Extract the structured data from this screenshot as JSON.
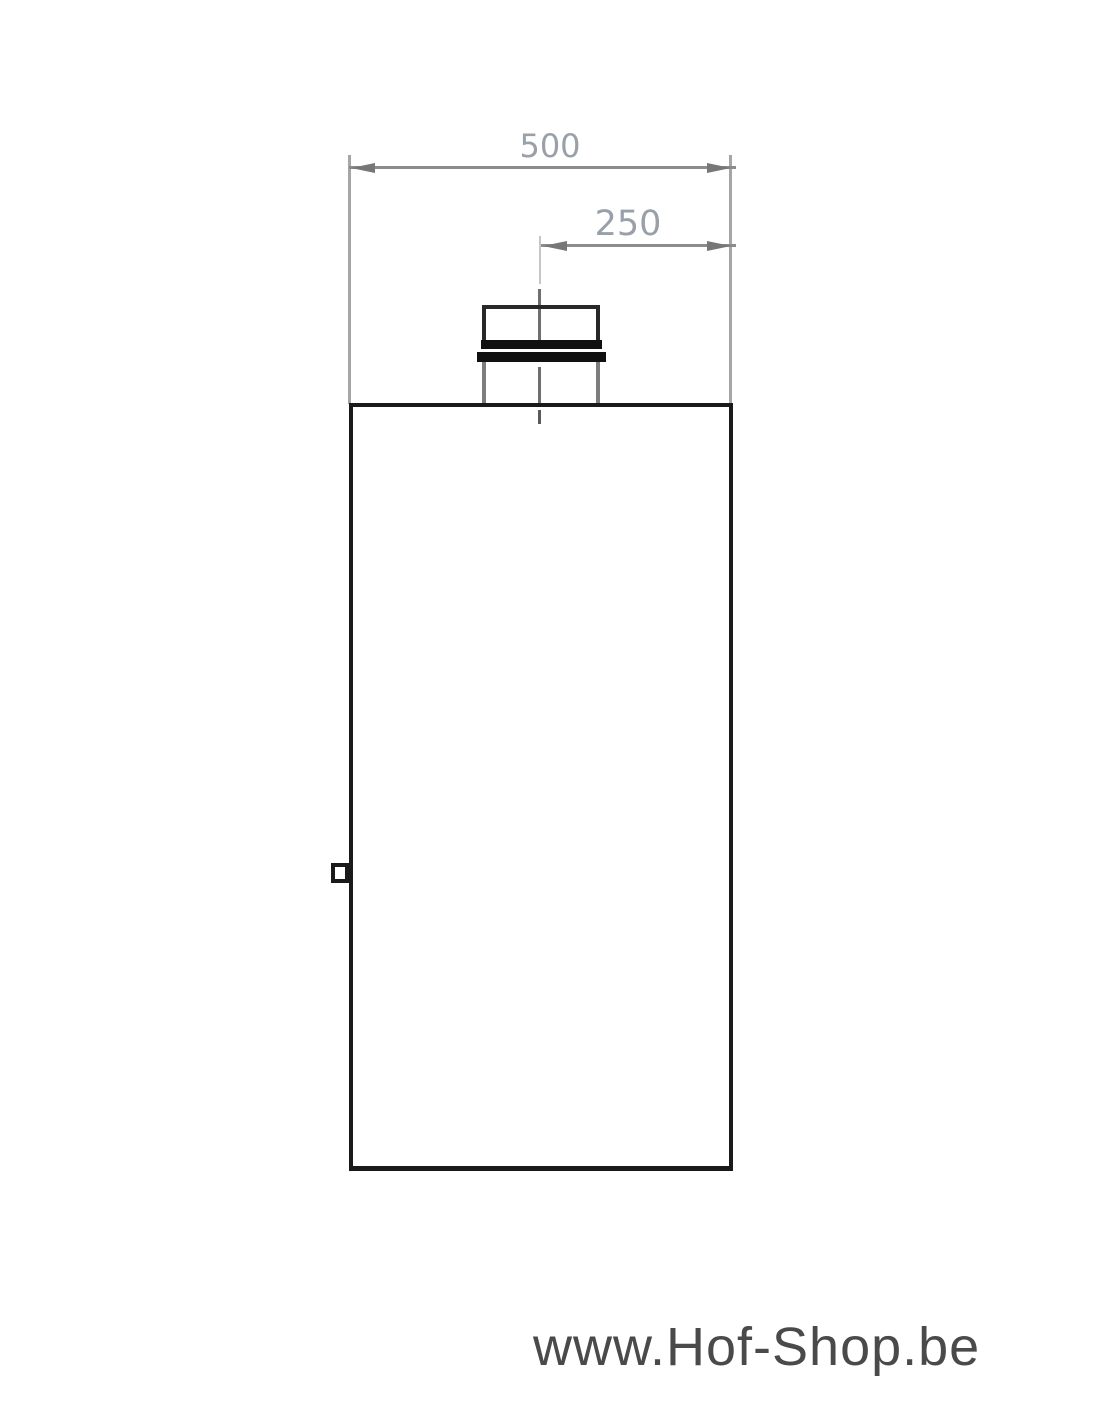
{
  "page": {
    "background": "#ffffff",
    "width_px": 1100,
    "height_px": 1422
  },
  "drawing": {
    "type": "technical-drawing",
    "dim_width": {
      "label": "500"
    },
    "dim_offset": {
      "label": "250"
    },
    "colors": {
      "outline": "#1a1a1a",
      "collar_flange": "#101010",
      "collar_lower_sides": "#7d7d7d",
      "dimension_line": "#8c8c8c",
      "extension_line": "#a6a6a6",
      "arrowhead": "#777777",
      "dimension_text": "#98a0aa",
      "centerline": "#6f6f6f",
      "watermark_text": "#4a4a4a"
    }
  },
  "watermark": {
    "text": "www.Hof-Shop.be"
  }
}
